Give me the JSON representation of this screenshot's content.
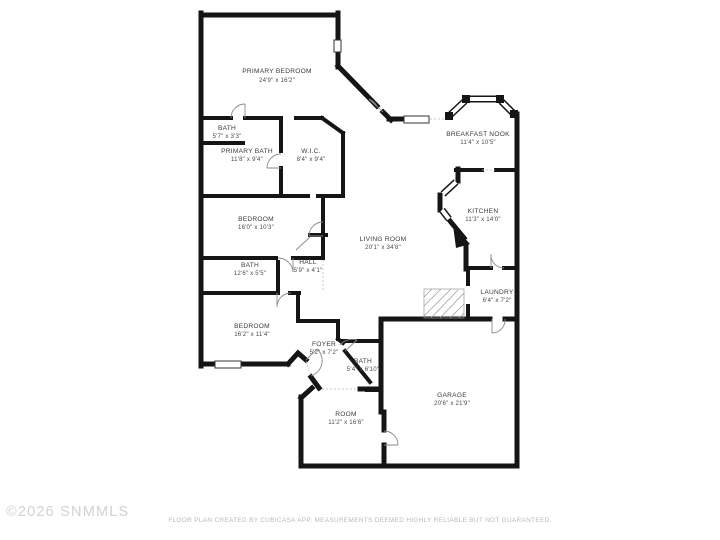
{
  "watermark": "©2026 SNMMLS",
  "footer": "FLOOR PLAN CREATED BY CUBICASA APP. MEASUREMENTS DEEMED HIGHLY RELIABLE BUT NOT GUARANTEED.",
  "colors": {
    "wall": "#151515",
    "label": "#3a3a3a",
    "footer_text": "#b9b9b9",
    "watermark_text": "#d2d2d2",
    "background": "#ffffff"
  },
  "rooms": [
    {
      "name": "PRIMARY BEDROOM",
      "dims": "24'9\" x 16'2\""
    },
    {
      "name": "BATH",
      "dims": "5'7\" x 3'3\""
    },
    {
      "name": "PRIMARY BATH",
      "dims": "11'8\" x 9'4\""
    },
    {
      "name": "W.I.C.",
      "dims": "8'4\" x 9'4\""
    },
    {
      "name": "BREAKFAST NOOK",
      "dims": "11'4\" x 10'5\""
    },
    {
      "name": "KITCHEN",
      "dims": "11'3\" x 14'0\""
    },
    {
      "name": "LIVING ROOM",
      "dims": "20'1\" x 34'8\""
    },
    {
      "name": "BEDROOM",
      "dims": "16'0\" x 10'3\""
    },
    {
      "name": "BATH",
      "dims": "12'6\" x 5'5\""
    },
    {
      "name": "HALL",
      "dims": "5'9\" x 4'1\""
    },
    {
      "name": "BEDROOM",
      "dims": "16'2\" x 11'4\""
    },
    {
      "name": "FOYER",
      "dims": "5'2\" x 7'2\""
    },
    {
      "name": "BATH",
      "dims": "5'4\" x 6'10\""
    },
    {
      "name": "LAUNDRY",
      "dims": "6'4\" x 7'2\""
    },
    {
      "name": "GARAGE",
      "dims": "20'6\" x 21'9\""
    },
    {
      "name": "ROOM",
      "dims": "11'2\" x 16'6\""
    }
  ]
}
